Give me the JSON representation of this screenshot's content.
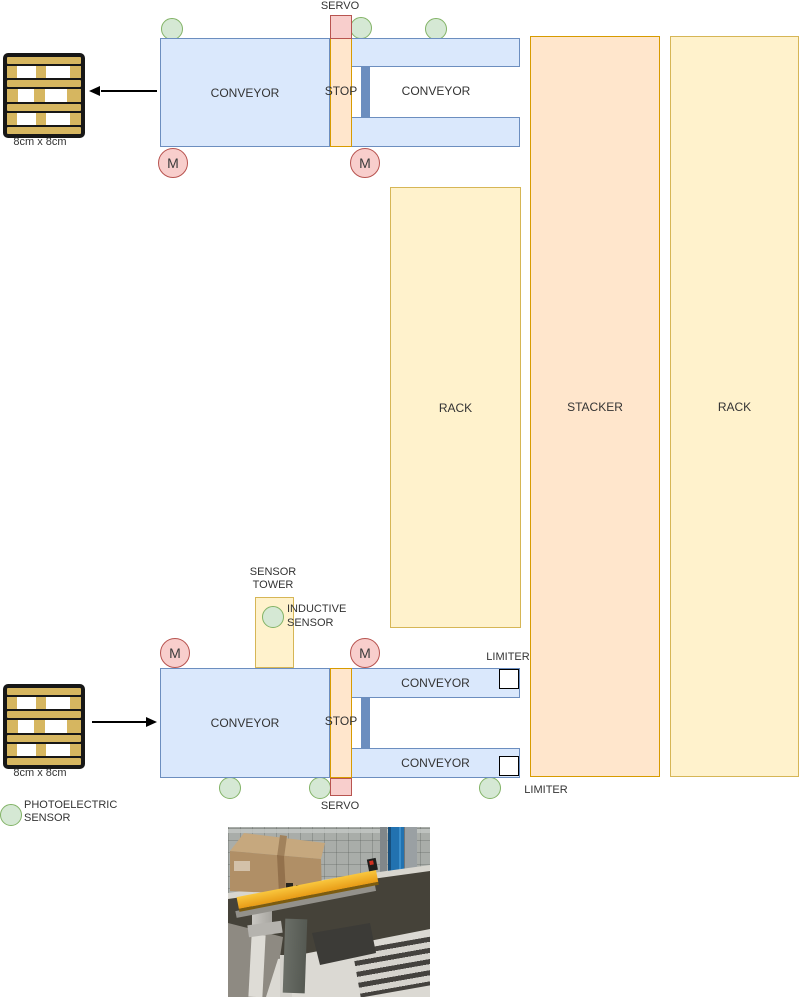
{
  "top_station": {
    "servo_label": "SERVO",
    "main_conveyor": "CONVEYOR",
    "stop": "STOP",
    "branch_conveyor": "CONVEYOR",
    "motor": "M"
  },
  "bottom_station": {
    "sensor_tower": {
      "line1": "SENSOR",
      "line2": "TOWER"
    },
    "inductive_sensor": {
      "line1": "INDUCTIVE",
      "line2": "SENSOR"
    },
    "main_conveyor": "CONVEYOR",
    "stop": "STOP",
    "branch_conveyor_top": "CONVEYOR",
    "branch_conveyor_bottom": "CONVEYOR",
    "limiter_top": "LIMITER",
    "limiter_bottom": "LIMITER",
    "servo_label": "SERVO",
    "motor": "M"
  },
  "storage": {
    "rack_inner": "RACK",
    "stacker": "STACKER",
    "rack_outer": "RACK"
  },
  "pallet_out": {
    "size": "8cm x 8cm"
  },
  "pallet_in": {
    "size": "8cm x 8cm"
  },
  "legend": {
    "photoelectric": {
      "line1": "PHOTOELECTRIC",
      "line2": "SENSOR"
    }
  },
  "colors": {
    "conveyor_fill": "#dae8fc",
    "conveyor_stroke": "#6c8ebf",
    "stop_zone_fill": "#ffe6cc",
    "stop_zone_stroke": "#d79b00",
    "rack_fill": "#fff2cc",
    "rack_stroke": "#d6b656",
    "stacker_fill": "#ffe6cc",
    "stacker_stroke": "#d79b00",
    "servo_fill": "#f8cecc",
    "servo_stroke": "#b85450",
    "sensor_fill": "#d5e8d4",
    "sensor_stroke": "#82b366",
    "motor_fill": "#f8cecc",
    "motor_stroke": "#b85450",
    "gate_fill": "#6c8ebf",
    "pallet_wood": "#d6b660",
    "text": "#333333"
  }
}
